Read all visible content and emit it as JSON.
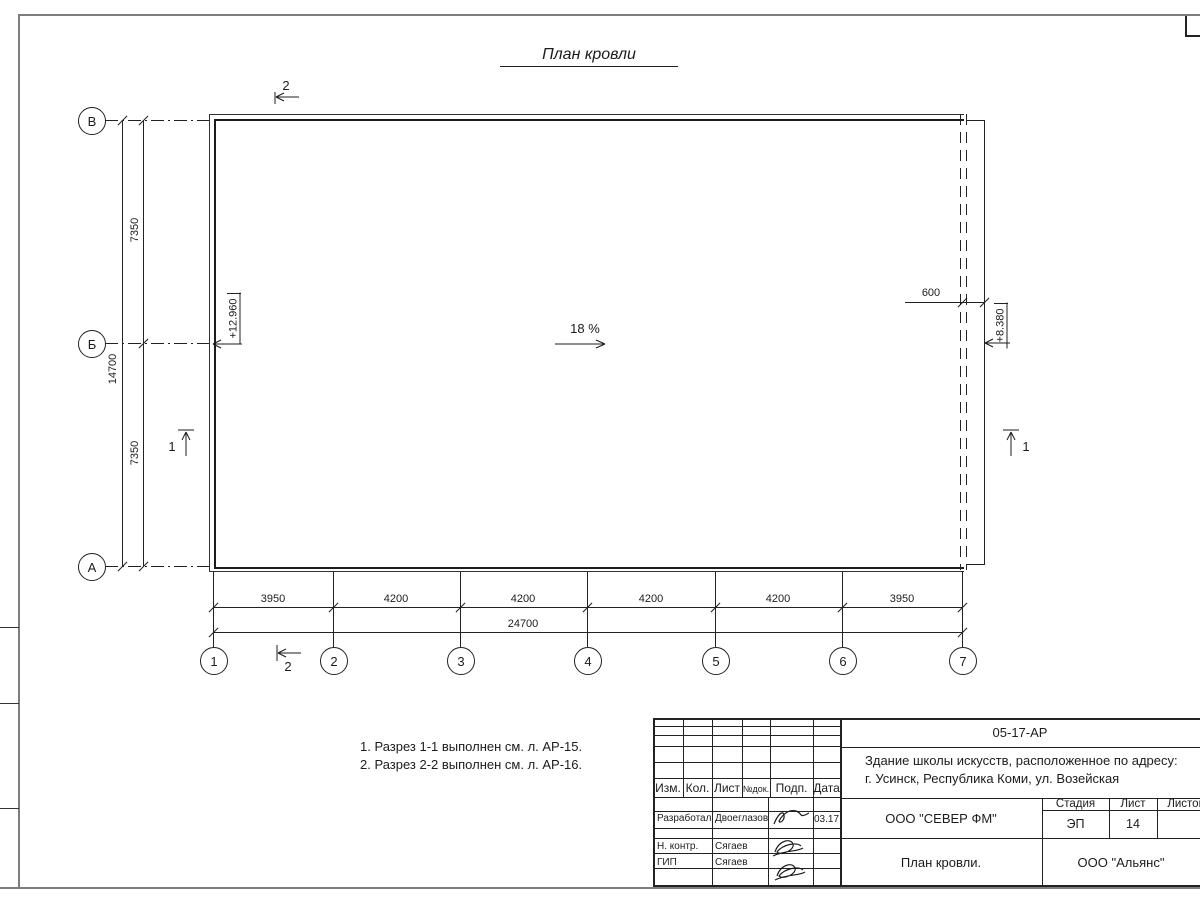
{
  "title": "План кровли",
  "slope": {
    "label": "18 %"
  },
  "axes": {
    "vertical": [
      "В",
      "Б",
      "А"
    ],
    "horizontal": [
      "1",
      "2",
      "3",
      "4",
      "5",
      "6",
      "7"
    ]
  },
  "dimensions": {
    "left_segments": [
      "7350",
      "7350"
    ],
    "left_total": "14700",
    "bottom_segments": [
      "3950",
      "4200",
      "4200",
      "4200",
      "4200",
      "3950"
    ],
    "bottom_total": "24700",
    "right_offset": "600"
  },
  "elevations": {
    "left": "+12.960",
    "right": "+8.380"
  },
  "sections": {
    "s1": "1",
    "s2": "2"
  },
  "notes": [
    "1. Разрез 1-1 выполнен см. л. АР-15.",
    "2. Разрез 2-2 выполнен см. л. АР-16."
  ],
  "title_block": {
    "doc_number": "05-17-АР",
    "project_line1": "Здание школы искусств, расположенное по адресу:",
    "project_line2": "г. Усинск, Республика Коми, ул. Возейская",
    "columns": [
      "Изм.",
      "Кол.",
      "Лист",
      "№док.",
      "Подп.",
      "Дата"
    ],
    "rows": [
      {
        "role": "Разработал",
        "name": "Двоеглазов",
        "date": "03.17"
      },
      {
        "role": "Н. контр.",
        "name": "Сягаев"
      },
      {
        "role": "ГИП",
        "name": "Сягаев"
      }
    ],
    "organization": "ООО \"СЕВЕР ФМ\"",
    "sheet_title": "План кровли.",
    "contractor": "ООО \"Альянс\"",
    "stage_label": "Стадия",
    "stage_value": "ЭП",
    "sheet_label": "Лист",
    "sheet_value": "14",
    "sheets_label": "Листов"
  }
}
